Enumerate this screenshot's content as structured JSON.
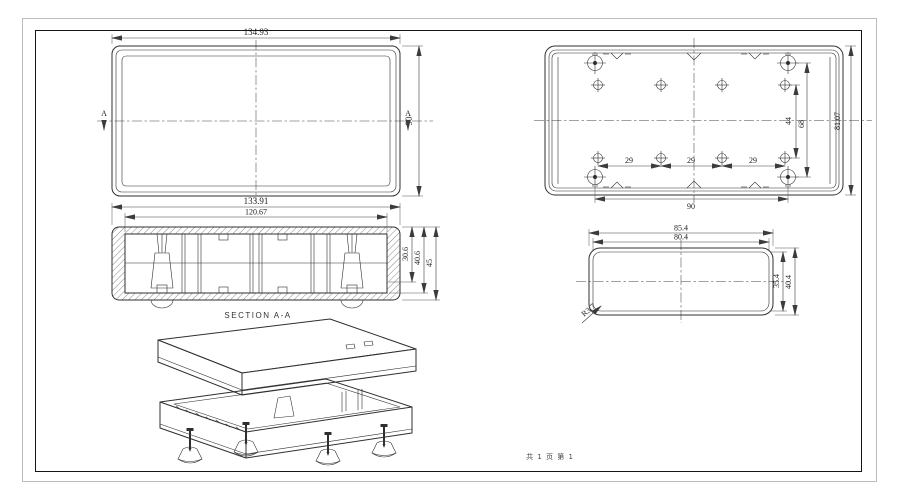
{
  "sheet": {
    "note": "共 1 页  第 1"
  },
  "views": {
    "top": {
      "width_dim": "134.93",
      "height_dim": "90",
      "section_marker_left": "A",
      "section_marker_right": "A"
    },
    "bottom": {
      "pitch_dims": [
        "29",
        "29",
        "29"
      ],
      "boss_span_dim": "90",
      "row_pitch_dim": "44",
      "corner_row_pitch_dim": "68",
      "height_dim": "81.07"
    },
    "section": {
      "label": "SECTION  A-A",
      "outer_width_dim": "133.91",
      "inner_width_dim": "120.67",
      "depth1_dim": "30.6",
      "depth2_dim": "40.6",
      "depth3_dim": "45"
    },
    "end": {
      "outer_width_dim": "85.4",
      "inner_width_dim": "80.4",
      "inner_height_dim": "35.4",
      "outer_height_dim": "40.4",
      "corner_radius_dim": "R3.7"
    }
  },
  "colors": {
    "line": "#2f2f2f",
    "dimension": "#3c3c3c",
    "frame": "#141414",
    "border": "#bcbcbc",
    "background": "#ffffff"
  }
}
